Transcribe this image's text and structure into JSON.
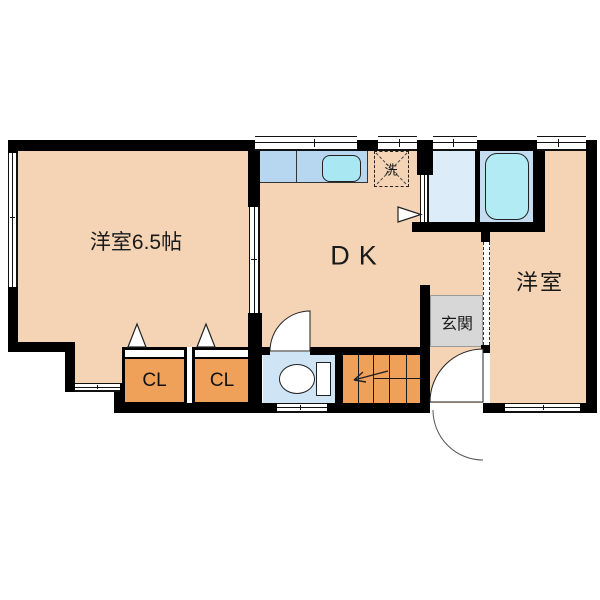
{
  "floorplan": {
    "title": "apartment-floor-plan",
    "rooms": {
      "western_room_left": {
        "label": "洋室6.5帖"
      },
      "dining_kitchen": {
        "label": "DK"
      },
      "western_room_right": {
        "label": "洋室"
      },
      "entrance": {
        "label": "玄関"
      },
      "closet_1": {
        "label": "CL"
      },
      "closet_2": {
        "label": "CL"
      },
      "washer_pan": {
        "label": "洗"
      }
    },
    "fixtures": [
      "kitchen-counter",
      "kitchen-sink",
      "washing-machine-pan",
      "bathtub",
      "toilet",
      "staircase",
      "entrance-door-swing",
      "closet-doors",
      "sliding-door",
      "windows"
    ],
    "colors": {
      "background": "#ffffff",
      "wall": "#000000",
      "floor": "#f4d4b5",
      "closet": "#f0a159",
      "stairs": "#f0a159",
      "counter": "#b7d6ef",
      "sink": "#a9e7f2",
      "washroom": "#dcecf8",
      "bathroom": "#c5ddf0",
      "bathtub": "#b2ebf4",
      "toilet_room": "#cfe4f4",
      "entrance": "#d7d7d8"
    }
  }
}
